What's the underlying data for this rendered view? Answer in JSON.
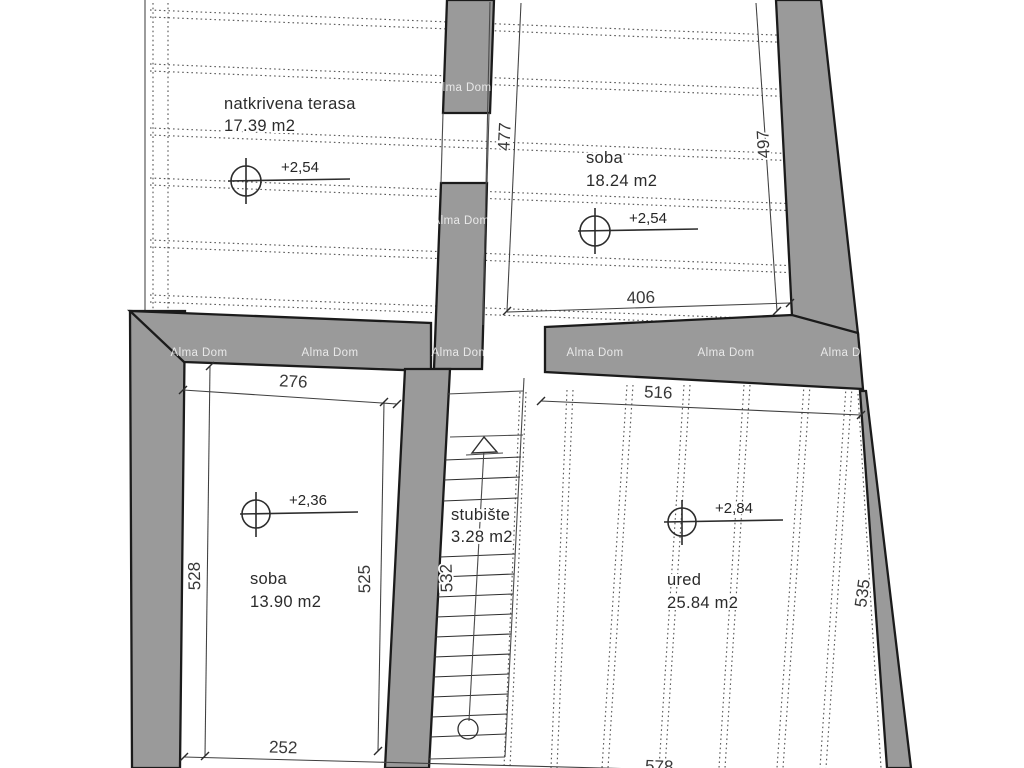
{
  "watermark": {
    "text": "Alma Dom"
  },
  "rooms": [
    {
      "id": "natkrivena-terasa",
      "label": "natkrivena terasa",
      "area": "17.39 m2",
      "elevation": "+2,54"
    },
    {
      "id": "soba-gornja",
      "label": "soba",
      "area": "18.24 m2",
      "elevation": "+2,54"
    },
    {
      "id": "soba-donja",
      "label": "soba",
      "area": "13.90 m2",
      "elevation": "+2,36"
    },
    {
      "id": "stubiste",
      "label": "stubište",
      "area": "3.28 m2"
    },
    {
      "id": "ured",
      "label": "ured",
      "area": "25.84 m2",
      "elevation": "+2,84"
    }
  ],
  "dims": {
    "d477": "477",
    "d497": "497",
    "d406": "406",
    "d276": "276",
    "d516": "516",
    "d528": "528",
    "d525": "525",
    "d532": "532",
    "d535": "535",
    "d252": "252",
    "d578": "578"
  },
  "colors": {
    "wall": "#9a9a9a",
    "outline": "#1b1b1b",
    "dimline": "#3f3f3f",
    "background": "#ffffff"
  }
}
